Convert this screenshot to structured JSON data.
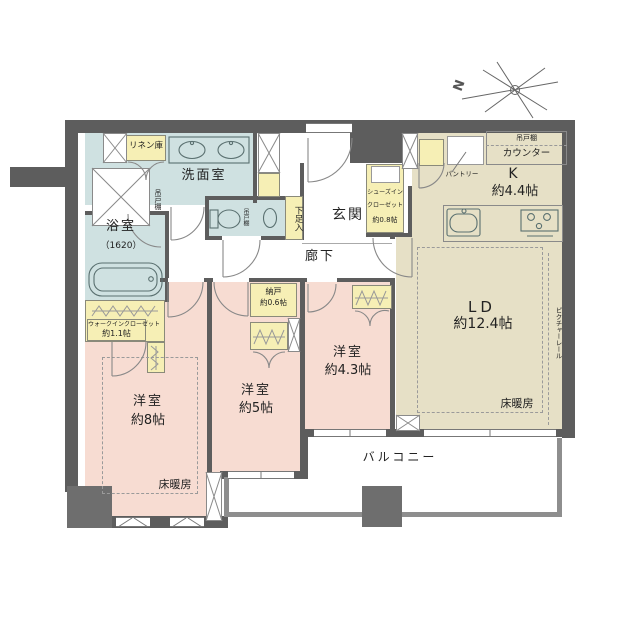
{
  "compass": {
    "north": "N"
  },
  "rooms": {
    "washroom": {
      "label": "洗面室",
      "shelf": "吊戸棚"
    },
    "linen": {
      "label": "リネン庫"
    },
    "bath": {
      "label": "浴室",
      "size": "（1620）"
    },
    "toilet": {
      "shelf": "吊戸棚"
    },
    "wic": {
      "label": "ウォークインクローゼット",
      "size": "約1.1帖"
    },
    "bedroom8": {
      "label": "洋室",
      "size": "約8帖",
      "heating": "床暖房"
    },
    "bedroom5": {
      "label": "洋室",
      "size": "約5帖"
    },
    "storage": {
      "label": "納戸",
      "size": "約0.6帖"
    },
    "bedroom43": {
      "label": "洋室",
      "size": "約4.3帖"
    },
    "entrance": {
      "label": "玄関"
    },
    "shoe_cabinet": {
      "label": "下足入"
    },
    "shoes_in_closet": {
      "line1": "シューズイン",
      "line2": "クローゼット",
      "size": "約0.8帖"
    },
    "hallway": {
      "label": "廊下"
    },
    "kitchen": {
      "label": "K",
      "size": "約4.4帖",
      "shelf": "吊戸棚",
      "counter": "カウンター",
      "pantry": "パントリー"
    },
    "living_dining": {
      "label": "LD",
      "size": "約12.4帖",
      "heating": "床暖房",
      "picture_rail": "ピクチャーレール"
    },
    "balcony": {
      "label": "バルコニー"
    }
  },
  "colors": {
    "wall": "#5d5d5d",
    "room_pink": "#f7dcd2",
    "room_blue": "#cfe1e1",
    "room_beige": "#e6e0c6",
    "closet_yellow": "#f6efb5"
  }
}
